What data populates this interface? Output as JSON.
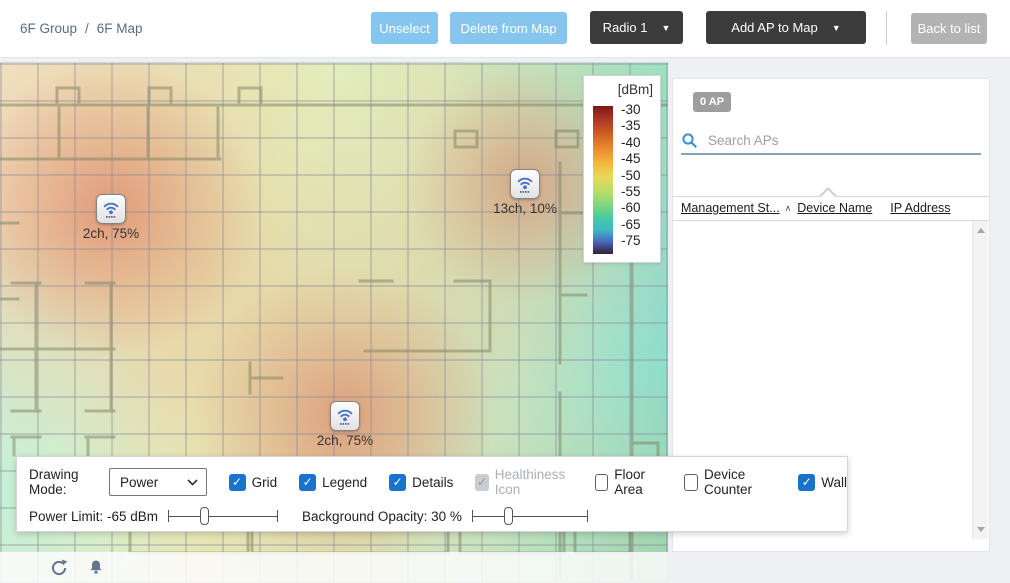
{
  "breadcrumb": {
    "group": "6F Group",
    "separator": "/",
    "current": "6F Map"
  },
  "toolbar": {
    "unselect": "Unselect",
    "delete_from_map": "Delete from Map",
    "radio": "Radio 1",
    "add_ap_to_map": "Add AP to Map",
    "back_to_list": "Back to list",
    "dropdown_arrow": "▼"
  },
  "map": {
    "aps": [
      {
        "label": "2ch, 75%"
      },
      {
        "label": "13ch, 10%"
      },
      {
        "label": "2ch, 75%"
      }
    ],
    "legend": {
      "title": "[dBm]",
      "ticks": [
        "-30",
        "-35",
        "-40",
        "-45",
        "-50",
        "-55",
        "-60",
        "-65",
        "-75"
      ]
    }
  },
  "sidebar": {
    "ap_count": "0 AP",
    "search_placeholder": "Search APs",
    "sort_indicator": "∧",
    "columns": [
      {
        "label": "Management St..."
      },
      {
        "label": "Device Name"
      },
      {
        "label": "IP Address"
      }
    ]
  },
  "controls": {
    "drawing_mode_label": "Drawing Mode:",
    "drawing_mode_value": "Power",
    "checkboxes": [
      {
        "label": "Grid",
        "checked": true,
        "disabled": false
      },
      {
        "label": "Legend",
        "checked": true,
        "disabled": false
      },
      {
        "label": "Details",
        "checked": true,
        "disabled": false
      },
      {
        "label": "Healthiness Icon",
        "checked": true,
        "disabled": true
      },
      {
        "label": "Floor Area",
        "checked": false,
        "disabled": false
      },
      {
        "label": "Device Counter",
        "checked": false,
        "disabled": false
      },
      {
        "label": "Wall",
        "checked": true,
        "disabled": false
      }
    ],
    "power_limit_label": "Power Limit: -65 dBm",
    "power_limit_value": "-65 dBm",
    "background_opacity_label": "Background Opacity: 30 %",
    "background_opacity_value": "30 %"
  },
  "colors": {
    "accent_blue_button": "#85c5ee",
    "dark_button": "#3b3b3b",
    "gray_button": "#b3b3b3",
    "checkbox_checked": "#1873cc",
    "heat_hot": "#d66850",
    "heat_cold": "#7cdac9",
    "legend_top": "#7a1a15",
    "legend_bottom": "#2e2338"
  }
}
